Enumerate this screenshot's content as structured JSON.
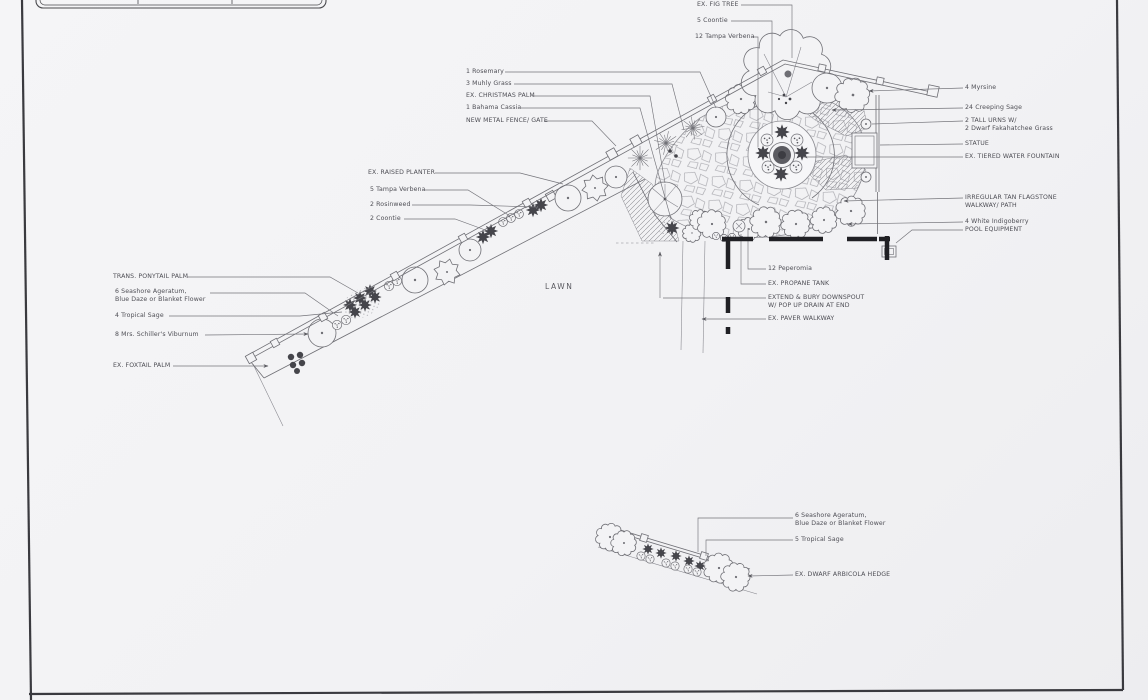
{
  "colors": {
    "paper": "#f3f3f5",
    "ink": "#6f6f75",
    "label_text": "#4e4e55",
    "wall": "#202024",
    "plant_dark": "#45454b"
  },
  "plan": {
    "callouts": {
      "fig_tree": "EX. FIG TREE",
      "coontie_5": "5 Coontie",
      "tampa_verbena_12": "12 Tampa Verbena",
      "rosemary_1": "1 Rosemary",
      "muhly_grass_3": "3 Muhly Grass",
      "christmas_palm": "EX. CHRISTMAS PALM",
      "bahama_cassia_1": "1 Bahama Cassia",
      "metal_fence_gate": "NEW METAL FENCE/ GATE",
      "raised_planter": "EX. RAISED PLANTER",
      "tampa_verbena_5": "5 Tampa Verbena",
      "rosinweed_2": "2 Rosinweed",
      "coontie_2": "2 Coontie",
      "myrsine_4": "4 Myrsine",
      "creeping_sage_24": "24 Creeping Sage",
      "tall_urns_line1": "2 TALL URNS W/",
      "tall_urns_line2": "2 Dwarf Fakahatchee Grass",
      "statue": "STATUE",
      "tiered_fountain": "EX. TIERED WATER FOUNTAIN",
      "flagstone_line1": "IRREGULAR TAN FLAGSTONE",
      "flagstone_line2": "WALKWAY/ PATH",
      "white_indigoberry_4": "4 White Indigoberry",
      "pool_equipment": "POOL EQUIPMENT",
      "peperomia_12": "12 Peperomia",
      "propane_tank": "EX. PROPANE TANK",
      "downspout_line1": "EXTEND & BURY DOWNSPOUT",
      "downspout_line2": "W/ POP UP DRAIN AT END",
      "paver_walkway": "EX. PAVER WALKWAY",
      "ponytail_palm": "TRANS. PONYTAIL PALM",
      "ageratum_upper_line1": "6 Seashore Ageratum,",
      "ageratum_upper_line2": "Blue Daze or Blanket Flower",
      "tropical_sage_4": "4 Tropical Sage",
      "viburnum_8": "8 Mrs. Schiller's Viburnum",
      "foxtail_palm": "EX. FOXTAIL PALM",
      "lawn": "LAWN",
      "ageratum_lower_line1": "6 Seashore Ageratum,",
      "ageratum_lower_line2": "Blue Daze or Blanket Flower",
      "tropical_sage_5": "5 Tropical Sage",
      "arbicola_hedge": "EX. DWARF ARBICOLA HEDGE"
    }
  }
}
